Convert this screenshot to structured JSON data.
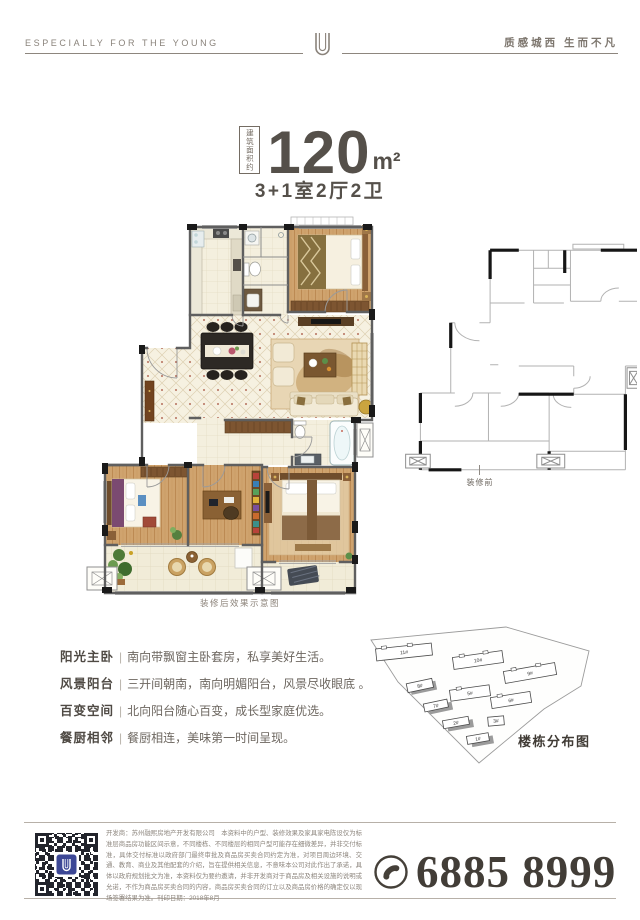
{
  "header": {
    "tagline_en": "ESPECIALLY FOR THE YOUNG",
    "tagline_cn": "质感城西  生而不凡"
  },
  "unit": {
    "area_prefix": "建筑面积约",
    "area_value": "120",
    "area_unit": "m²",
    "layout": "3+1室2厅2卫"
  },
  "plans": {
    "after_caption": "装修后效果示意图",
    "before_caption": "装修前"
  },
  "features_sep": "|",
  "features": [
    {
      "label": "阳光主卧",
      "desc": "南向带飘窗主卧套房，私享美好生活。"
    },
    {
      "label": "风景阳台",
      "desc": "三开间朝南，南向明媚阳台，风景尽收眼底 。"
    },
    {
      "label": "百变空间",
      "desc": "北向阳台随心百变，成长型家庭优选。"
    },
    {
      "label": "餐厨相邻",
      "desc": "餐厨相连，美味第一时间呈现。"
    }
  ],
  "siteplan": {
    "caption": "楼栋分布图",
    "buildings": [
      "11#",
      "10#",
      "9#",
      "8#",
      "5#",
      "6#",
      "7#",
      "2#",
      "3#",
      "1#"
    ]
  },
  "footer": {
    "disclaimer": "开发商：苏州融熙房地产开发有限公司　本资料中的户型、装修效果及家具家电陈设仅为标准层商品房功能区间示意，不同楼栋、不同楼层的相同户型可能存在细微差异，并非交付标准，具体交付标准以政府部门最终审批及商品房买卖合同约定为准，对项目周边环境、交通、教育、商业及其他配套的介绍，旨在提供相关信息，不意味本公司对此作出了承诺，具体以政府规划批文为准，本资料仅为要约邀请，并非开发商对于商品房及相关设施的说明或允诺，不作为商品房买卖合同的内容，商品房买卖合同的订立以及商品房价格的确定仅以现场签署结果为准。刊印日期：2018年8月",
    "phone": "6885 8999"
  }
}
